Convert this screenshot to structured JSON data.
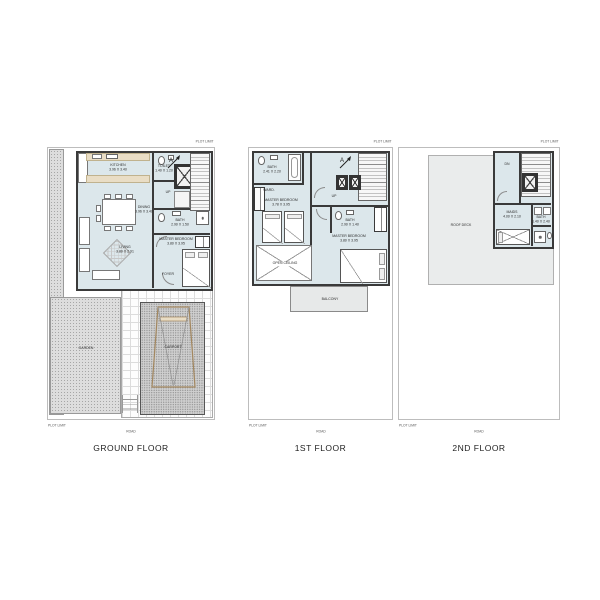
{
  "common": {
    "plot_limit": "PLOT LIMIT",
    "road": "ROAD"
  },
  "ground_floor": {
    "caption": "GROUND FLOOR",
    "stairs_label": "UP",
    "section_marker": "A",
    "rooms": {
      "kitchen": {
        "name": "KITCHEN",
        "dims": "3.96 X 3.40"
      },
      "dining": {
        "name": "DINING",
        "dims": "3.96 X 3.40"
      },
      "living": {
        "name": "LIVING",
        "dims": "3.80 X 2.91"
      },
      "toilet": {
        "name": "TOILET",
        "dims": "1.40 X 1.20"
      },
      "bath": {
        "name": "BATH",
        "dims": "2.90 X 1.50"
      },
      "master_bedroom": {
        "name": "MASTER BEDROOM",
        "dims": "3.80 X 3.95"
      },
      "foyer": {
        "name": "FOYER"
      },
      "garden": {
        "name": "GARDEN"
      },
      "carport": {
        "name": "CARPORT"
      }
    }
  },
  "first_floor": {
    "caption": "1ST FLOOR",
    "stairs_label": "UP",
    "section_marker": "A",
    "rooms": {
      "bath_left": {
        "name": "BATH",
        "dims": "2.41 X 2.20"
      },
      "wardrobe": {
        "name": "WARD."
      },
      "master_bedroom_left": {
        "name": "MASTER BEDROOM",
        "dims": "3.78 X 3.95"
      },
      "master_bedroom_right": {
        "name": "MASTER BEDROOM",
        "dims": "3.80 X 3.95"
      },
      "bath_right": {
        "name": "BATH",
        "dims": "2.90 X 1.40"
      },
      "open_ceiling": {
        "name": "OPEN CEILING"
      },
      "balcony": {
        "name": "BALCONY"
      }
    }
  },
  "second_floor": {
    "caption": "2ND FLOOR",
    "stairs_label": "DN",
    "rooms": {
      "roof_deck": {
        "name": "ROOF DECK"
      },
      "maids": {
        "name": "MAIDS",
        "dims": "4.00 X 2.10"
      },
      "bath": {
        "name": "BATH",
        "dims": "1.40 X 2.40"
      }
    }
  },
  "colors": {
    "wall": "#3a3a3a",
    "room_floor": "#dce7eb",
    "roof_deck": "#eaecec",
    "counter": "#e9ddc5",
    "car_outline": "#a3875f"
  }
}
